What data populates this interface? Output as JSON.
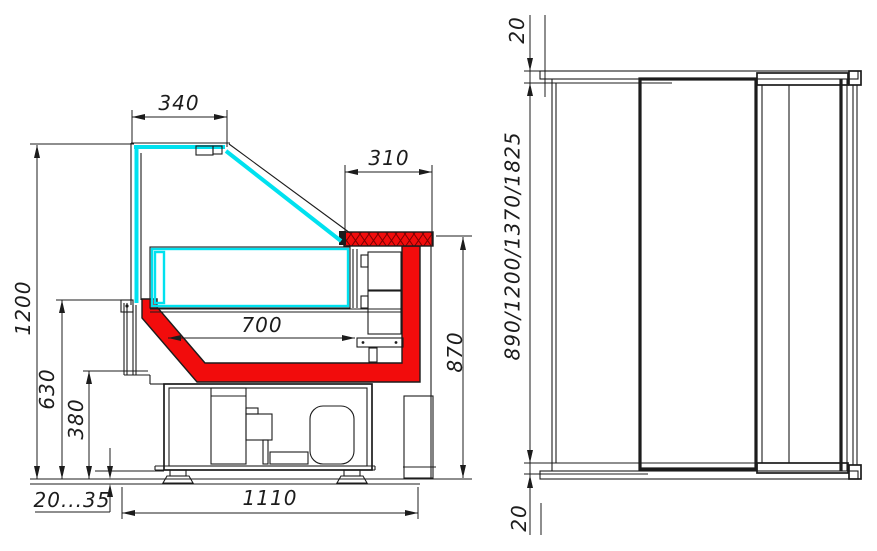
{
  "drawing": {
    "kind": "refrigerated-display-counter-technical-drawing",
    "colors": {
      "line": "#1c1c1c",
      "glass": "#00e1ef",
      "accent": "#f20c0c",
      "hatch": "#7a0000"
    },
    "section_view": {
      "dims": {
        "top_glass_width": "340",
        "counter_depth": "310",
        "display_inner_width": "700",
        "overall_height": "1200",
        "mid_height": "630",
        "base_height": "380",
        "counter_height": "870",
        "foot_adjust_range": "20...35",
        "overall_depth": "1110"
      }
    },
    "front_view": {
      "dims": {
        "top_offset": "20",
        "height_options": "890/1200/1370/1825",
        "bottom_offset": "20"
      }
    }
  }
}
